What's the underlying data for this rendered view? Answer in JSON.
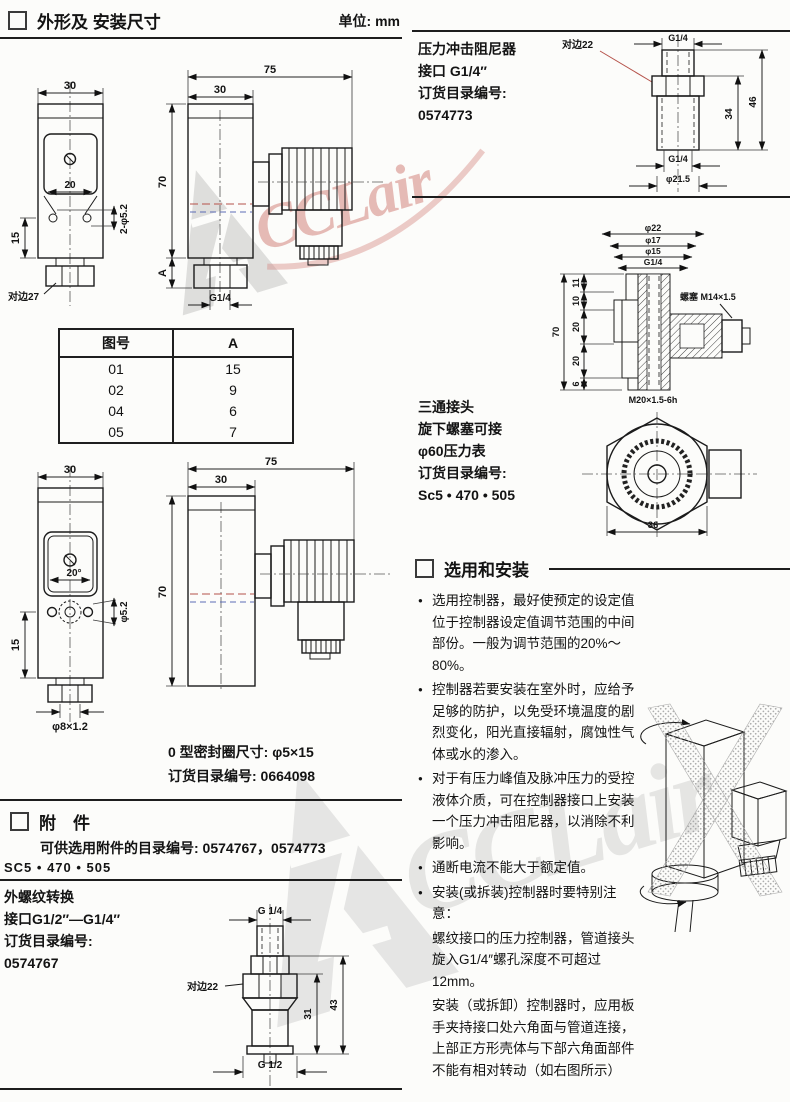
{
  "watermark": {
    "brand": "CCLair"
  },
  "left": {
    "header": {
      "title": "外形及 安装尺寸",
      "unit": "单位: mm"
    },
    "drawing1": {
      "front": {
        "w30": "30",
        "w20": "20",
        "holes": "2-φ5.2",
        "h15": "15",
        "hex27": "对边27"
      },
      "side": {
        "w75": "75",
        "w30": "30",
        "h70": "70",
        "hA": "A",
        "thread": "G1/4"
      }
    },
    "table": {
      "col1": "图号",
      "col2": "A",
      "rows": [
        [
          "01",
          "15"
        ],
        [
          "02",
          "9"
        ],
        [
          "04",
          "6"
        ],
        [
          "05",
          "7"
        ]
      ]
    },
    "drawing2": {
      "front": {
        "w30": "30",
        "a20": "20°",
        "d52": "φ5.2",
        "h15": "15",
        "d8": "φ8×1.2"
      },
      "side": {
        "w75": "75",
        "w30": "30",
        "h70": "70"
      }
    },
    "oring": {
      "line1": "0 型密封圈尺寸: φ5×15",
      "line2": "订货目录编号: 0664098"
    },
    "accessories": {
      "title": "附　件",
      "line1": "可供选用附件的目录编号: 0574767，0574773",
      "line2": "SC5 • 470 • 505"
    },
    "adapter": {
      "lines": [
        "外螺纹转换",
        "接口G1/2″—G1/4″",
        "订货目录编号:",
        "0574767"
      ],
      "drawing": {
        "top": "G 1/4",
        "hex22": "对边22",
        "d31": "31",
        "d43": "43",
        "bottom": "G 1/2"
      }
    }
  },
  "right": {
    "damper": {
      "lines": [
        "压力冲击阻尼器",
        "接口 G1/4″",
        "订货目录编号:",
        "0574773"
      ],
      "drawing": {
        "hex22": "对边22",
        "top": "G1/4",
        "d34": "34",
        "d46": "46",
        "bottom": "G1/4",
        "dia": "φ21.5"
      }
    },
    "tee": {
      "lines": [
        "三通接头",
        "旋下螺塞可接",
        "φ60压力表",
        "订货目录编号:",
        "Sc5 • 470 • 505"
      ],
      "drawing": {
        "d22": "φ22",
        "d17": "φ17",
        "d15": "φ15",
        "g14": "G1/4",
        "s11": "11",
        "s10": "10",
        "s20a": "20",
        "s20b": "20",
        "s6": "6",
        "h70": "70",
        "plug": "螺塞 M14×1.5",
        "m20": "M20×1.5-6h",
        "w36": "36"
      }
    },
    "install": {
      "title": "选用和安装",
      "bullets": [
        "选用控制器，最好使预定的设定值位于控制器设定值调节范围的中间部份。一般为调节范围的20%～80%。",
        "控制器若要安装在室外时，应给予足够的防护，以免受环境温度的剧烈变化，阳光直接辐射，腐蚀性气体或水的渗入。",
        "对于有压力峰值及脉冲压力的受控液体介质，可在控制器接口上安装一个压力冲击阻尼器，以消除不利影响。",
        "通断电流不能大于额定值。",
        "安装(或拆装)控制器时要特别注意："
      ],
      "note1": "螺纹接口的压力控制器，管道接头旋入G1/4″螺孔深度不可超过12mm。",
      "note2": "安装（或拆卸）控制器时，应用板手夹持接口处六角面与管道连接，上部正方形壳体与下部六角面部件不能有相对转动（如右图所示）"
    }
  }
}
